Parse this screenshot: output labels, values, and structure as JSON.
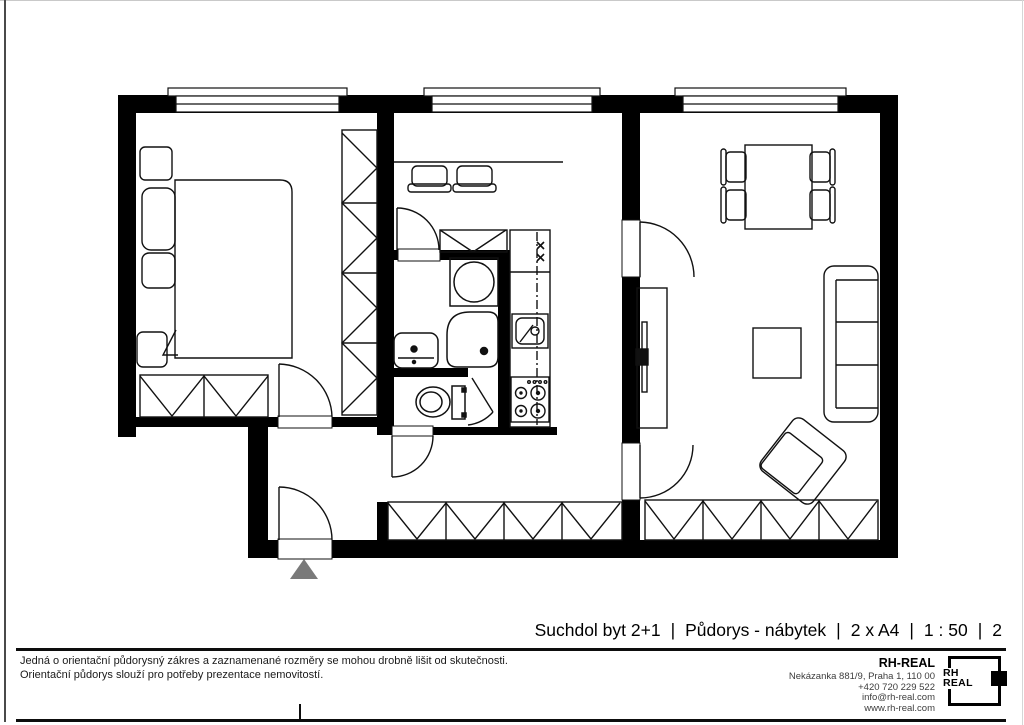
{
  "titlebar": {
    "separator": "|",
    "segments": [
      "Suchdol byt 2+1",
      "Půdorys - nábytek",
      "2 x A4",
      "1 : 50",
      "2"
    ]
  },
  "footer": {
    "disclaimer_line1": "Jedná o orientační půdorysný zákres a zaznamenané rozměry se mohou drobně lišit od skutečnosti.",
    "disclaimer_line2": "Orientační půdorys slouží pro potřeby prezentace nemovitostí.",
    "company": {
      "name": "RH-REAL",
      "address": "Nekázanka 881/9, Praha 1, 110 00",
      "phone": "+420 720 229 522",
      "email": "info@rh-real.com",
      "web": "www.rh-real.com"
    },
    "logo": {
      "line1": "RH",
      "line2": "REAL"
    }
  },
  "floorplan": {
    "wall_color": "#000000",
    "line_color": "#111111",
    "entry_marker_color": "#7a7a7a",
    "symbols": [
      "window",
      "door",
      "bed",
      "pillow",
      "nightstand",
      "wardrobe",
      "washing-machine",
      "shower",
      "washbasin",
      "toilet",
      "kitchen-counter",
      "kitchen-sink",
      "stove",
      "dining-table",
      "chair",
      "sofa",
      "coffee-table",
      "tv",
      "armchair",
      "entry-arrow"
    ]
  }
}
